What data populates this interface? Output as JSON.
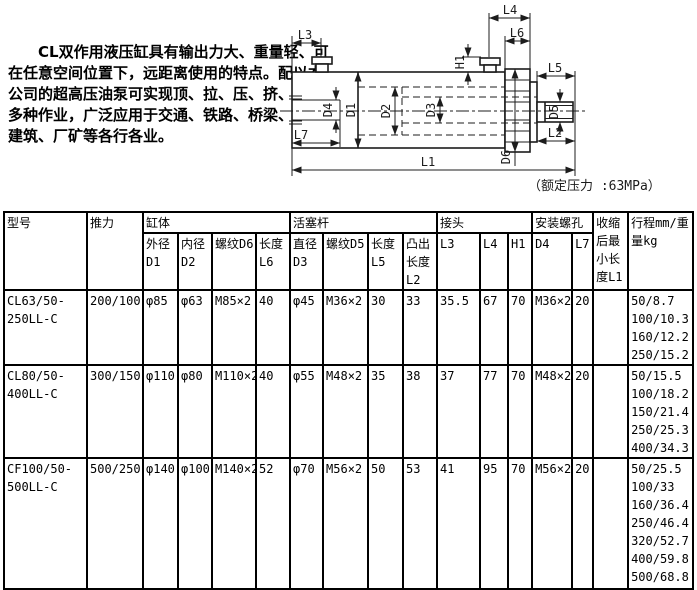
{
  "intro": {
    "lines": [
      "　　CL双作用液压缸具有输出力大、重量轻、可",
      "在任意空间位置下，远距离使用的特点。配以本",
      "公司的超高压油泵可实现顶、拉、压、挤、推等",
      "多种作业，广泛应用于交通、铁路、桥梁、地铁",
      "建筑、厂矿等各行各业。"
    ]
  },
  "diagram": {
    "caption": "（额定压力 :63MPa）",
    "labels": {
      "L1": "L1",
      "L2": "L2",
      "L3": "L3",
      "L4": "L4",
      "L5": "L5",
      "L6": "L6",
      "L7": "L7",
      "H1": "H1",
      "D1": "D1",
      "D2": "D2",
      "D3": "D3",
      "D4": "D4",
      "D5": "D5",
      "D6": "D6"
    }
  },
  "table": {
    "headers": {
      "model": "型号",
      "thrust": "推力",
      "cylinder": "缸体",
      "cyl_od": "外径\nD1",
      "cyl_id": "内径\nD2",
      "cyl_thread": "螺纹D6",
      "cyl_len": "长度\nL6",
      "piston": "活塞杆",
      "rod_dia": "直径\nD3",
      "rod_thread": "螺纹D5",
      "rod_len": "长度\nL5",
      "rod_protrude": "凸出\n长度\nL2",
      "joint": "接头",
      "l3": "L3",
      "l4": "L4",
      "h1": "H1",
      "mount": "安装螺孔",
      "d4": "D4",
      "l7": "L7",
      "min_len": "收缩\n后最\n小长\n度L1",
      "stroke": "行程mm/重\n量kg"
    },
    "rows": [
      {
        "model": "CL63/50-\n250LL-C",
        "thrust": "200/100",
        "cyl_od": "φ85",
        "cyl_id": "φ63",
        "cyl_thread": "M85×2",
        "cyl_len": "40",
        "rod_dia": "φ45",
        "rod_thread": "M36×2",
        "rod_len": "30",
        "rod_protrude": "33",
        "l3": "35.5",
        "l4": "67",
        "h1": "70",
        "d4": "M36×2",
        "l7": "20",
        "min_len": "",
        "stroke": "50/8.7\n100/10.3\n160/12.2\n250/15.2"
      },
      {
        "model": "CL80/50-\n400LL-C",
        "thrust": "300/150",
        "cyl_od": "φ110",
        "cyl_id": "φ80",
        "cyl_thread": "M110×2",
        "cyl_len": "40",
        "rod_dia": "φ55",
        "rod_thread": "M48×2",
        "rod_len": "35",
        "rod_protrude": "38",
        "l3": "37",
        "l4": "77",
        "h1": "70",
        "d4": "M48×2",
        "l7": "20",
        "min_len": "",
        "stroke": "50/15.5\n100/18.2\n150/21.4\n250/25.3\n400/34.3"
      },
      {
        "model": "CF100/50-\n500LL-C",
        "thrust": "500/250",
        "cyl_od": "φ140",
        "cyl_id": "φ100",
        "cyl_thread": "M140×2",
        "cyl_len": "52",
        "rod_dia": "φ70",
        "rod_thread": "M56×2",
        "rod_len": "50",
        "rod_protrude": "53",
        "l3": "41",
        "l4": "95",
        "h1": "70",
        "d4": "M56×2",
        "l7": "20",
        "min_len": "",
        "stroke": "50/25.5\n100/33\n160/36.4\n250/46.4\n320/52.7\n400/59.8\n500/68.8"
      }
    ]
  }
}
